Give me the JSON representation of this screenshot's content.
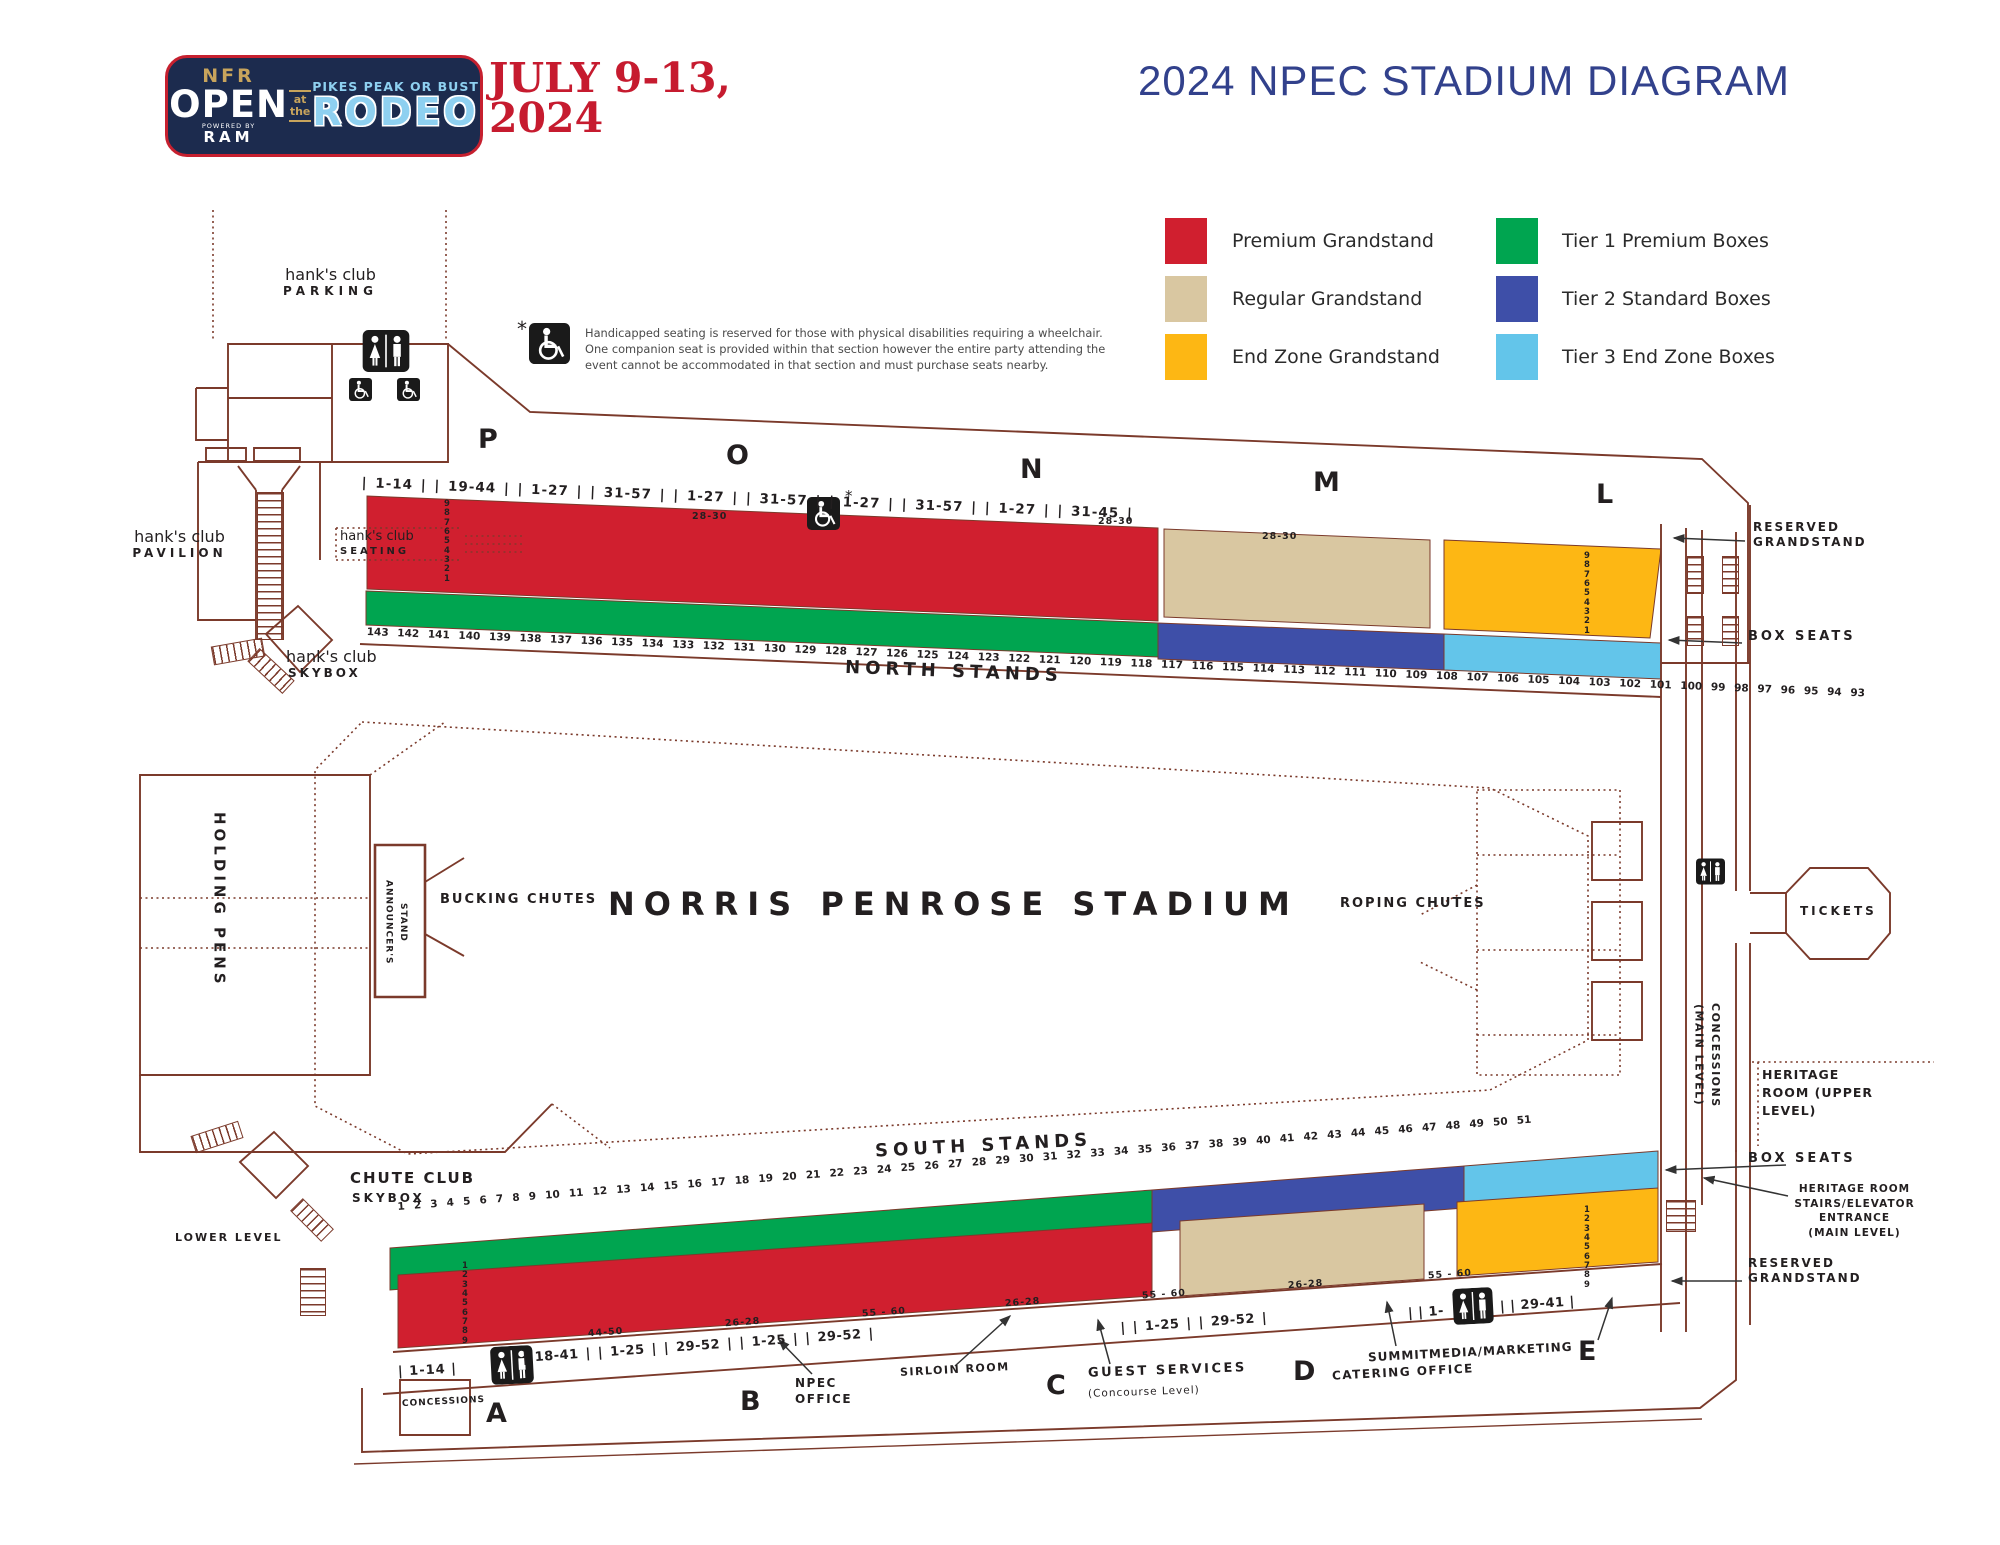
{
  "colors": {
    "outline": "#7b3a2b",
    "premium": "#d01f2f",
    "regular": "#d9c7a1",
    "endzone": "#fdb714",
    "tier1": "#00a550",
    "tier2": "#3e4fa8",
    "tier3": "#63c5ea",
    "title_navy": "#32418c",
    "logo_navy": "#1c2b4e",
    "logo_gold": "#c8a45c",
    "logo_blue": "#8ed0f0",
    "accent_red": "#c61b2f"
  },
  "header": {
    "logo": {
      "nfr": "NFR",
      "open": "OPEN",
      "powered_by": "POWERED BY",
      "ram": "RAM",
      "at_the": "at\nthe",
      "tagline": "PIKES PEAK OR BUST",
      "rodeo": "RODEO"
    },
    "dates_line1": "JULY 9-13,",
    "dates_line2": "2024",
    "title": "2024 NPEC STADIUM DIAGRAM"
  },
  "legend": {
    "items": [
      {
        "label": "Premium Grandstand",
        "color": "#d01f2f"
      },
      {
        "label": "Regular Grandstand",
        "color": "#d9c7a1"
      },
      {
        "label": "End Zone Grandstand",
        "color": "#fdb714"
      },
      {
        "label": "Tier 1 Premium Boxes",
        "color": "#00a550"
      },
      {
        "label": "Tier 2 Standard Boxes",
        "color": "#3e4fa8"
      },
      {
        "label": "Tier 3 End Zone Boxes",
        "color": "#63c5ea"
      }
    ]
  },
  "disclaimer": {
    "asterisk": "*",
    "text": "Handicapped seating is reserved for those with physical disabilities requiring a wheelchair. One companion seat is provided within that section however the entire party attending the event cannot be accommodated in that section and must purchase seats nearby."
  },
  "north": {
    "parking_name": "hank's club",
    "parking_sub": "PARKING",
    "pavilion_name": "hank's club",
    "pavilion_sub": "PAVILION",
    "seating_name": "hank's club",
    "seating_sub": "SEATING",
    "skybox_name": "hank's club",
    "skybox_sub": "SKYBOX",
    "letters": [
      "P",
      "O",
      "N",
      "M",
      "L"
    ],
    "ranges": "| 1-14 | | 19-44 | | 1-27 | | 31-57 | | 1-27 | | 31-57 | | 1-27 | | 31-57 | | 1-27 | | 31-45 |",
    "aisle_1": "28-30",
    "aisle_2": "28-30",
    "aisle_3": "28-30",
    "asterisk": "*",
    "rows_red": "9\n8\n7\n6\n5\n4\n3\n2\n1",
    "rows_endzone": "9\n8\n7\n6\n5\n4\n3\n2\n1",
    "box_numbers": "143 142 141 140 139 138 137 136 135 134 133 132 131 130 129 128 127 126 125 124 123 122 121 120 119 118 117 116 115 114 113 112 111 110 109 108 107 106 105 104 103 102 101 100 99 98 97 96 95 94 93",
    "label": "NORTH STANDS",
    "reserved": "RESERVED\nGRANDSTAND",
    "box_seats": "BOX SEATS"
  },
  "center": {
    "holding_pens": "HOLDING PENS",
    "announcers_stand": "ANNOUNCER'S\nSTAND",
    "bucking_chutes": "BUCKING CHUTES",
    "stadium_name": "NORRIS PENROSE STADIUM",
    "roping_chutes": "ROPING CHUTES",
    "tickets": "TICKETS",
    "concessions_main": "CONCESSIONS\n(MAIN LEVEL)",
    "heritage_upper": "HERITAGE ROOM (UPPER LEVEL)"
  },
  "south": {
    "label": "SOUTH STANDS",
    "chute_club_line1": "CHUTE CLUB",
    "chute_club_line2": "SKYBOX",
    "lower_level": "LOWER LEVEL",
    "box_numbers": "1 2 3 4 5 6 7 8 9 10 11 12 13 14 15 16 17 18 19 20 21 22 23 24 25 26 27 28 29 30 31 32 33 34 35 36 37 38 39 40 41 42 43 44 45 46 47 48 49 50 51",
    "rows_red": "1\n2\n3\n4\n5\n6\n7\n8\n9",
    "rows_endzone": "1\n2\n3\n4\n5\n6\n7\n8\n9",
    "aisles": [
      "44-50",
      "26-28",
      "55 - 60",
      "26-28",
      "55 - 60",
      "26-28",
      "55 - 60"
    ],
    "ranges_1": "| 1-14 |",
    "ranges_2": "| 18-41 | | 1-25 | | 29-52 | | 1-25 | | 29-52 |",
    "ranges_3": "| | 1-25 | | 29-52 |",
    "ranges_4a": "| | 1-",
    "ranges_4b": "| | 29-41 |",
    "letters": [
      "A",
      "B",
      "C",
      "D",
      "E"
    ],
    "concessions": "CONCESSIONS",
    "npec_office": "NPEC\nOFFICE",
    "sirloin_room": "SIRLOIN ROOM",
    "guest_services": "GUEST SERVICES",
    "guest_services_sub": "(Concourse Level)",
    "summit": "SUMMITMEDIA/MARKETING",
    "catering": "CATERING OFFICE",
    "reserved": "RESERVED\nGRANDSTAND",
    "box_seats": "BOX SEATS",
    "heritage_stairs": "HERITAGE ROOM\nSTAIRS/ELEVATOR\nENTRANCE\n(MAIN LEVEL)"
  }
}
